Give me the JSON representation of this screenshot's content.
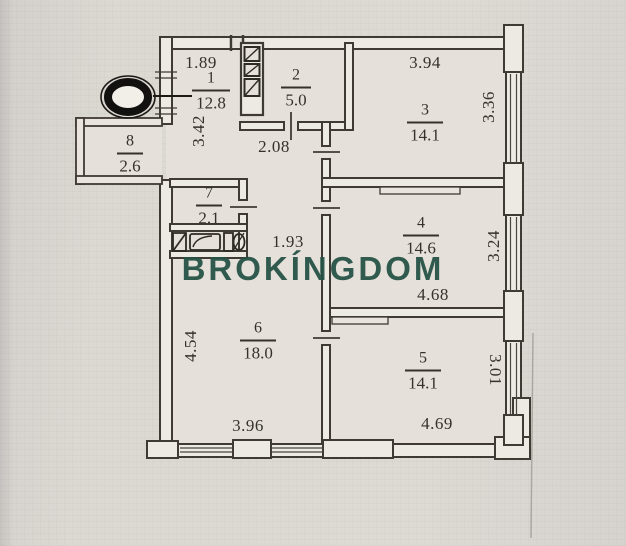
{
  "watermark": {
    "text": "BROKÍNGDOM",
    "color": "#265247"
  },
  "rooms": [
    {
      "number": "1",
      "area": "12.8"
    },
    {
      "number": "2",
      "area": "5.0"
    },
    {
      "number": "3",
      "area": "14.1"
    },
    {
      "number": "4",
      "area": "14.6"
    },
    {
      "number": "5",
      "area": "14.1"
    },
    {
      "number": "6",
      "area": "18.0"
    },
    {
      "number": "7",
      "area": "2.1"
    },
    {
      "number": "8",
      "area": "2.6"
    }
  ],
  "dimensions": [
    {
      "value": "1.89",
      "orientation": "horizontal"
    },
    {
      "value": "3.42",
      "orientation": "vertical"
    },
    {
      "value": "2.08",
      "orientation": "horizontal"
    },
    {
      "value": "3.94",
      "orientation": "horizontal"
    },
    {
      "value": "3.36",
      "orientation": "vertical"
    },
    {
      "value": "1.93",
      "orientation": "horizontal"
    },
    {
      "value": "3.24",
      "orientation": "vertical"
    },
    {
      "value": "4.68",
      "orientation": "horizontal"
    },
    {
      "value": "4.54",
      "orientation": "vertical"
    },
    {
      "value": "3.96",
      "orientation": "horizontal"
    },
    {
      "value": "3.01",
      "orientation": "vertical-flipped"
    },
    {
      "value": "4.69",
      "orientation": "horizontal"
    }
  ],
  "colors": {
    "paper": "#dcd8d2",
    "room_fill": "#e6e2db",
    "wall_ink": "#3f3a33",
    "text_ink": "#35312b",
    "watermark": "#265247"
  }
}
